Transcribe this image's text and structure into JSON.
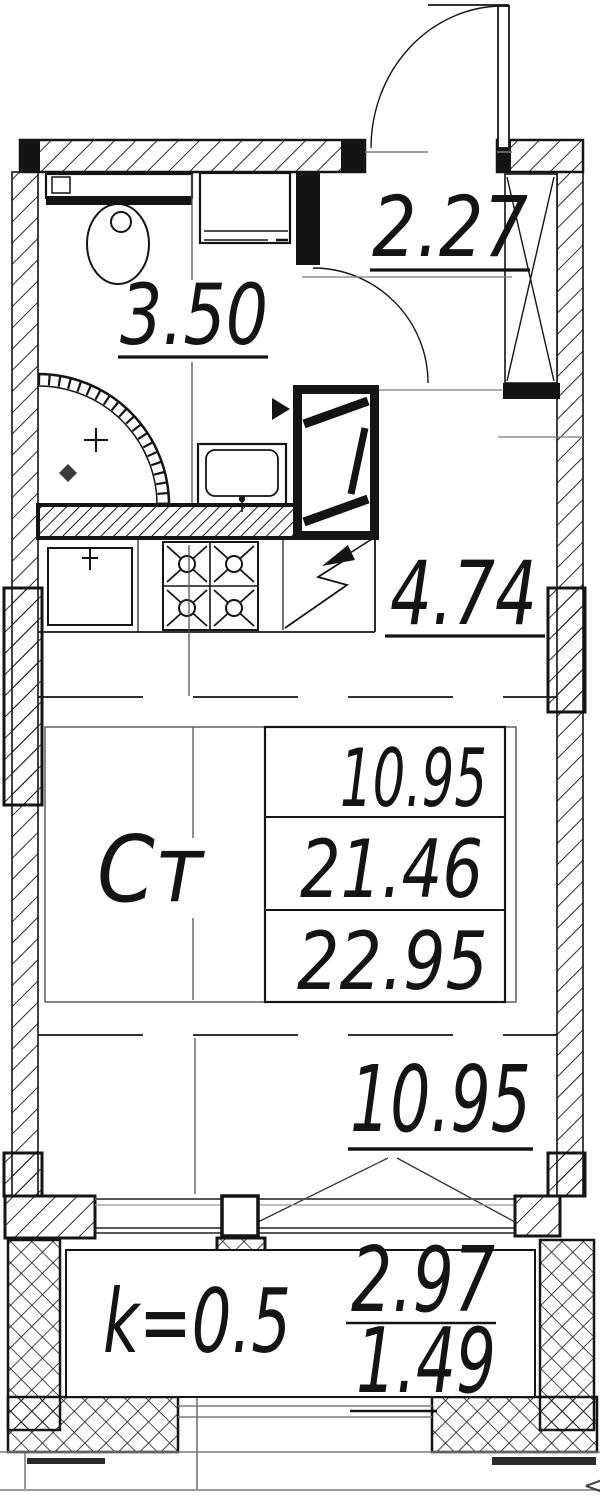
{
  "plan": {
    "hallway": {
      "area": "2.27"
    },
    "bathroom": {
      "area": "3.50"
    },
    "kitchen": {
      "area": "4.74"
    },
    "studio_label": "Ст",
    "area_table": {
      "rows": [
        "10.95",
        "21.46",
        "22.95"
      ]
    },
    "room": {
      "area": "10.95"
    },
    "balcony": {
      "coefficient": "k=0.5",
      "area_full": "2.97",
      "area_reduced": "1.49"
    },
    "misc": {
      "edge_mark": "<"
    }
  },
  "colors": {
    "line": "#141414",
    "aux": "#7b7b7b",
    "background": "#ffffff"
  }
}
